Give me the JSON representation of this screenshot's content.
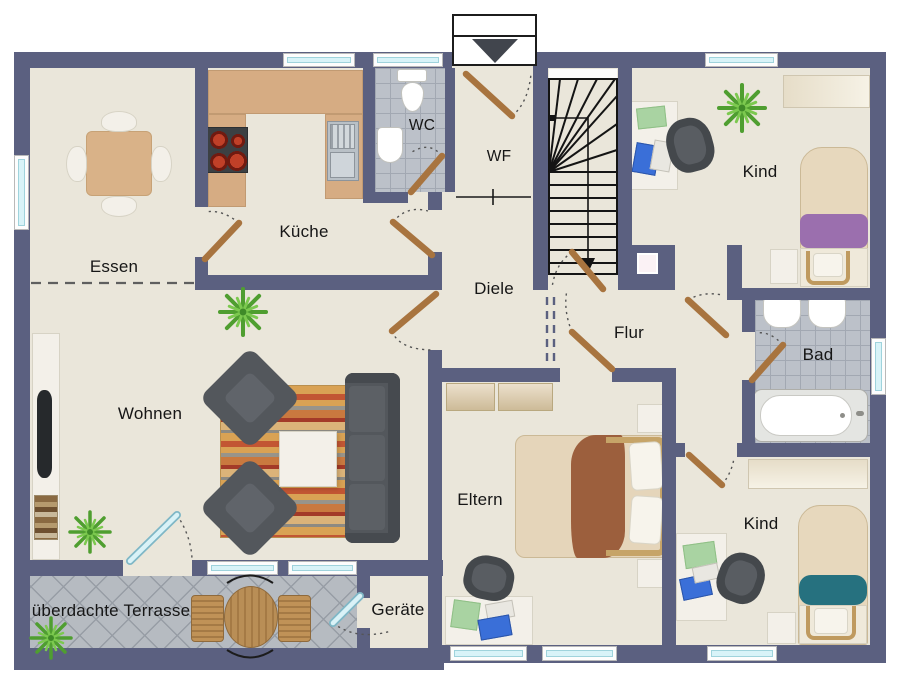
{
  "entrance_marker": {
    "arrow_icon": "▼"
  },
  "rooms": [
    {
      "id": "essen",
      "label": "Essen"
    },
    {
      "id": "kueche",
      "label": "Küche"
    },
    {
      "id": "wc",
      "label": "WC"
    },
    {
      "id": "wf",
      "label": "WF"
    },
    {
      "id": "diele",
      "label": "Diele"
    },
    {
      "id": "flur",
      "label": "Flur"
    },
    {
      "id": "kind_top",
      "label": "Kind"
    },
    {
      "id": "bad",
      "label": "Bad"
    },
    {
      "id": "wohnen",
      "label": "Wohnen"
    },
    {
      "id": "eltern",
      "label": "Eltern"
    },
    {
      "id": "kind_bottom",
      "label": "Kind"
    },
    {
      "id": "geraete",
      "label": "Geräte"
    },
    {
      "id": "terrasse",
      "label": "überdachte Terrasse"
    }
  ],
  "colors": {
    "wall": "#5b6080",
    "floor": "#eae6da",
    "bath_tile": "#bcc1c9",
    "terrace_tile": "#b6bbc1",
    "window_glass": "#d8f3f8",
    "door_wood": "#a8743f",
    "glass_door": "#d9f2f7",
    "kitchen_counter": "#d6ac83",
    "furniture_dark": "#53575c",
    "bed_blanket_purple": "#9b6fae",
    "bed_blanket_teal": "#26717f",
    "bed_blanket_brown": "#9c5f3d",
    "plant_green": "#4f9e30"
  }
}
